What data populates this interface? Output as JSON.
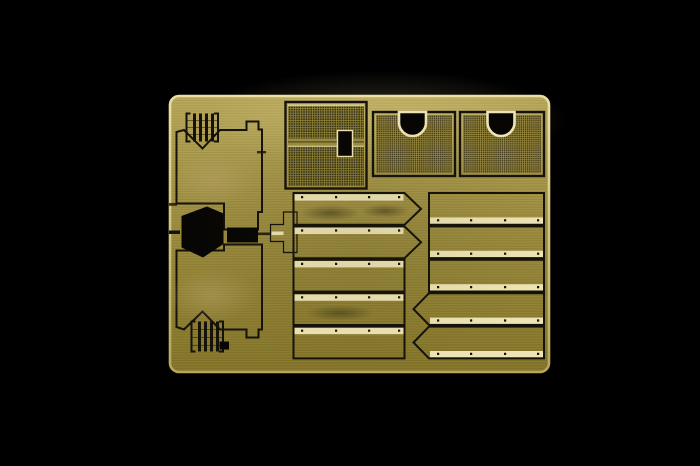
{
  "scene": {
    "type": "product-photograph",
    "subject": "photo-etched brass detail sheet for a scale model kit, centered on a black background",
    "background_color": "#000000"
  },
  "sheet": {
    "material_look": "brass",
    "parts": {
      "engine_deck_panels": 2,
      "louvered_vents": 2,
      "large_split_mesh_grille": 1,
      "mesh_grilles_with_semicircle_cutout": 2,
      "slat_panels_left_column": 5,
      "slat_panels_right_column": 5,
      "pointed_slats_left": 2,
      "pointed_slats_right": 2,
      "black_cutout_shapes": 4
    }
  },
  "colors": {
    "background": "#000000",
    "sheet_top": "#b6a658",
    "sheet_mid": "#9c8c3e",
    "sheet_bottom": "#837427",
    "edge_light": "#ecdfa2",
    "edge_dark": "#b7a65c",
    "etch_dark": "#15120a",
    "cream_panel": "#e7dbaa",
    "cream_strip": "#ede3b4",
    "black_cutout": "#070604",
    "mesh_dark": "#332e13",
    "mesh_line": "#978a3a",
    "mesh2_dark": "#423a1b",
    "mesh2_line": "#a19142",
    "bracket_fill": "#8d8034",
    "slat_dark_1": "#57511b",
    "slat_dark_2": "#7b7029",
    "slat_mid_1": "#6e6321",
    "slat_mid_2": "#918334",
    "slat_light_1": "#9a8c3e",
    "slat_light_2": "#c0b166",
    "slat_tan_1": "#c0b16c",
    "slat_tan_2": "#d5c88a",
    "slat_med_1": "#7a6e26",
    "slat_med_2": "#9e9043"
  }
}
